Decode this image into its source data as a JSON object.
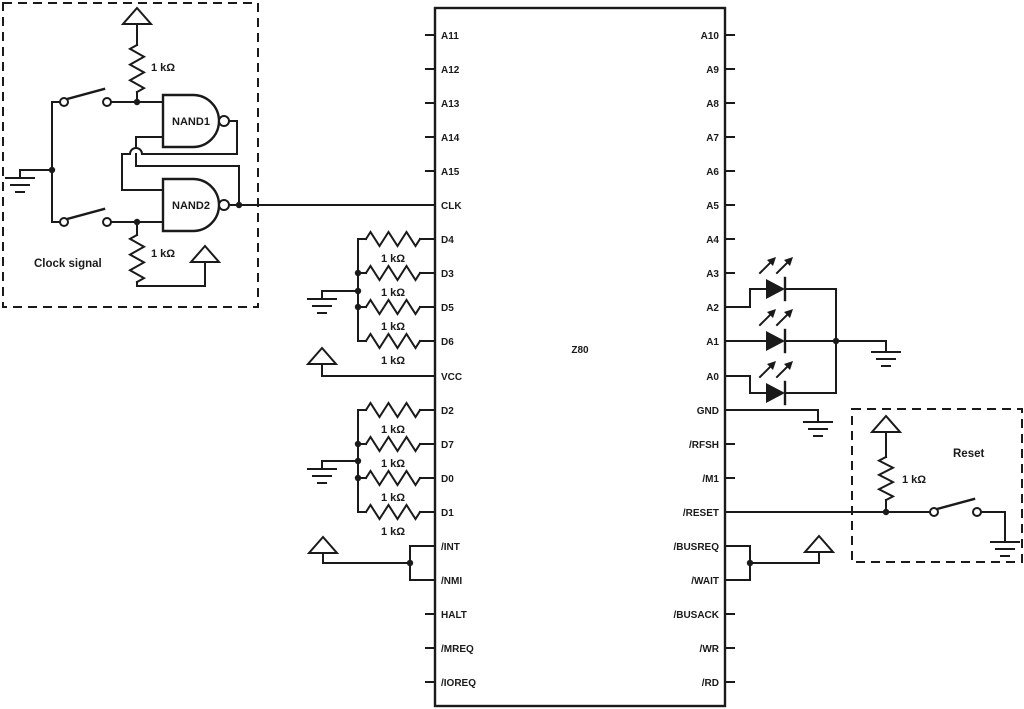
{
  "chip": {
    "label": "Z80",
    "left_pins": [
      "A11",
      "A12",
      "A13",
      "A14",
      "A15",
      "CLK",
      "D4",
      "D3",
      "D5",
      "D6",
      "VCC",
      "D2",
      "D7",
      "D0",
      "D1",
      "/INT",
      "/NMI",
      "HALT",
      "/MREQ",
      "/IOREQ"
    ],
    "right_pins": [
      "A10",
      "A9",
      "A8",
      "A7",
      "A6",
      "A5",
      "A4",
      "A3",
      "A2",
      "A1",
      "A0",
      "GND",
      "/RFSH",
      "/M1",
      "/RESET",
      "/BUSREQ",
      "/WAIT",
      "/BUSACK",
      "/WR",
      "/RD"
    ]
  },
  "clock_box": {
    "label": "Clock signal",
    "gate1_label": "NAND1",
    "gate2_label": "NAND2",
    "resistor_top": "1 kΩ",
    "resistor_bottom": "1 kΩ"
  },
  "pullup_group_upper": {
    "resistor_labels": [
      "1 kΩ",
      "1 kΩ",
      "1 kΩ",
      "1 kΩ"
    ]
  },
  "pullup_group_lower": {
    "resistor_labels": [
      "1 kΩ",
      "1 kΩ",
      "1 kΩ",
      "1 kΩ"
    ]
  },
  "reset_box": {
    "label": "Reset",
    "resistor_label": "1 kΩ"
  },
  "colors": {
    "wire": "#1a1a1a",
    "background": "#ffffff"
  }
}
